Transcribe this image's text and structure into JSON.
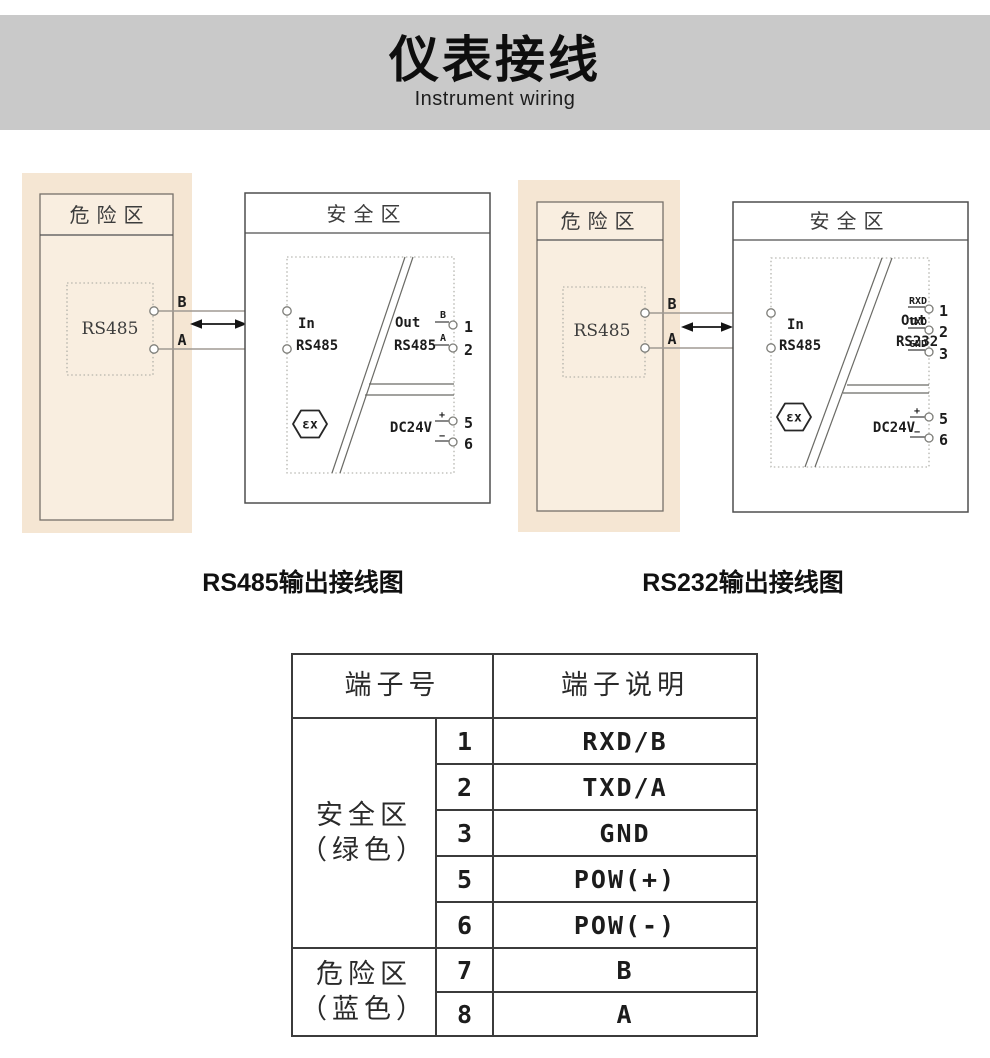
{
  "page": {
    "title": "仪表接线",
    "subtitle": "Instrument wiring"
  },
  "diagrams": [
    {
      "caption": "RS485输出接线图",
      "hazard": {
        "title": "危险区",
        "device": "RS485",
        "term_b": "B",
        "term_a": "A"
      },
      "safe": {
        "title": "安全区",
        "in_label_1": "In",
        "in_label_2": "RS485",
        "in_num_1": "7",
        "in_num_2": "8",
        "out_label_1": "Out",
        "out_label_2": "RS485",
        "out_terms": [
          {
            "label": "B",
            "num": "1"
          },
          {
            "label": "A",
            "num": "2"
          }
        ],
        "power_label": "DC24V",
        "power_terms": [
          {
            "label": "+",
            "num": "5"
          },
          {
            "label": "−",
            "num": "6"
          }
        ],
        "ex_mark": "εx"
      }
    },
    {
      "caption": "RS232输出接线图",
      "hazard": {
        "title": "危险区",
        "device": "RS485",
        "term_b": "B",
        "term_a": "A"
      },
      "safe": {
        "title": "安全区",
        "in_label_1": "In",
        "in_label_2": "RS485",
        "in_num_1": "7",
        "in_num_2": "8",
        "out_label_1": "Out",
        "out_label_2": "RS232",
        "out_terms": [
          {
            "label": "RXD",
            "num": "1"
          },
          {
            "label": "TXD",
            "num": "2"
          },
          {
            "label": "GND",
            "num": "3"
          }
        ],
        "power_label": "DC24V",
        "power_terms": [
          {
            "label": "+",
            "num": "5"
          },
          {
            "label": "−",
            "num": "6"
          }
        ],
        "ex_mark": "εx"
      }
    }
  ],
  "table": {
    "headers": {
      "terminal_no": "端子号",
      "terminal_desc": "端子说明"
    },
    "groups": [
      {
        "zone": "安全区\n（绿色）",
        "rows": [
          {
            "no": "1",
            "desc": "RXD/B"
          },
          {
            "no": "2",
            "desc": "TXD/A"
          },
          {
            "no": "3",
            "desc": "GND"
          },
          {
            "no": "5",
            "desc": "POW(+)"
          },
          {
            "no": "6",
            "desc": "POW(-)"
          }
        ]
      },
      {
        "zone": "危险区\n（蓝色）",
        "rows": [
          {
            "no": "7",
            "desc": "B"
          },
          {
            "no": "8",
            "desc": "A"
          }
        ]
      }
    ]
  }
}
